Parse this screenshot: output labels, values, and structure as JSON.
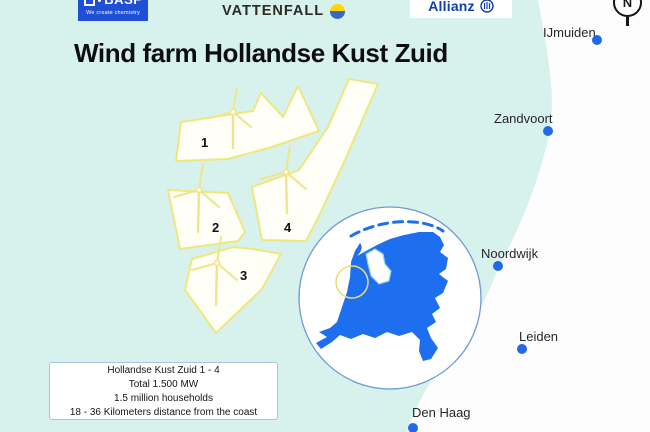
{
  "header": {
    "title": "Wind farm Hollandse Kust Zuid",
    "logos": {
      "basf": {
        "name": "BASF",
        "tagline": "We create chemistry"
      },
      "vattenfall": {
        "name": "VATTENFALL"
      },
      "allianz": {
        "name": "Allianz"
      }
    },
    "compass_label": "N"
  },
  "map": {
    "cities": [
      {
        "name": "IJmuiden"
      },
      {
        "name": "Zandvoort"
      },
      {
        "name": "Noordwijk"
      },
      {
        "name": "Leiden"
      },
      {
        "name": "Den Haag"
      }
    ],
    "zones": [
      {
        "label": "1"
      },
      {
        "label": "2"
      },
      {
        "label": "3"
      },
      {
        "label": "4"
      }
    ]
  },
  "info_box": {
    "line1": "Hollandse Kust Zuid 1 - 4",
    "line2": "Total 1.500 MW",
    "line3": "1.5 million households",
    "line4": "18 - 36 Kilometers distance from the coast"
  },
  "colors": {
    "sea": "#d7f2ec",
    "land": "#fcfdfc",
    "zone_fill": "#fffef7",
    "zone_border": "#eee77e",
    "city_dot": "#2368e8",
    "netherlands_blue": "#1e6ef0",
    "highlight_circle": "#e7dd79",
    "basf_blue": "#1e4fd6",
    "vattenfall_yellow": "#ffd800",
    "vattenfall_blue": "#3668c9",
    "allianz_blue": "#0e3fae",
    "info_border": "#a8c6de"
  }
}
